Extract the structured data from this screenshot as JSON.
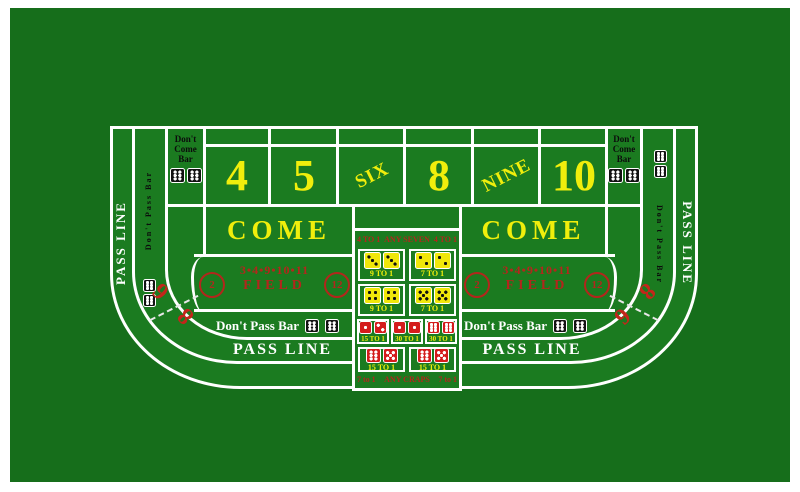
{
  "colors": {
    "felt": "#166e1b",
    "felt_light": "#1b7b20",
    "line": "#ffffff",
    "yellow": "#f0ee0c",
    "red": "#b3261c",
    "dice_red": "#d41c1c",
    "dice_yellow": "#f0e70a",
    "dice_black": "#131313"
  },
  "rails": {
    "pass_line": "PASS LINE",
    "dont_pass_bar": "Don't Pass Bar",
    "dont_pass_dice": [
      6,
      6
    ]
  },
  "dont_come": {
    "lines": [
      "Don't",
      "Come",
      "Bar"
    ],
    "dice": [
      6,
      6
    ]
  },
  "points": [
    "4",
    "5",
    "SIX",
    "8",
    "NINE",
    "10"
  ],
  "come_label": "COME",
  "field": {
    "numbers": "3•4•9•10•11",
    "label": "FIELD",
    "circle_left": "2",
    "circle_right": "12"
  },
  "big": {
    "six": "6",
    "eight": "8"
  },
  "center": {
    "any_seven": {
      "side": "4 TO 1",
      "label": "ANY SEVEN"
    },
    "hardways": [
      {
        "d1": 3,
        "d2": 3,
        "odds": "9 TO 1"
      },
      {
        "d1": 2,
        "d2": 2,
        "odds": "7 TO 1"
      },
      {
        "d1": 4,
        "d2": 4,
        "odds": "9 TO 1"
      },
      {
        "d1": 5,
        "d2": 5,
        "odds": "7 TO 1"
      }
    ],
    "row_three": [
      {
        "d1": 1,
        "d2": 2,
        "odds": "15 TO 1"
      },
      {
        "d1": 1,
        "d2": 1,
        "odds": "30 TO 1"
      },
      {
        "d1": 6,
        "d2": 6,
        "odds": "30 TO 1"
      }
    ],
    "row_two": [
      {
        "d1": 6,
        "d2": 5,
        "odds": "15 TO 1"
      },
      {
        "d1": 6,
        "d2": 5,
        "odds": "15 TO 1"
      }
    ],
    "any_craps": {
      "side": "7 to 1",
      "label": "ANY CRAPS"
    }
  }
}
